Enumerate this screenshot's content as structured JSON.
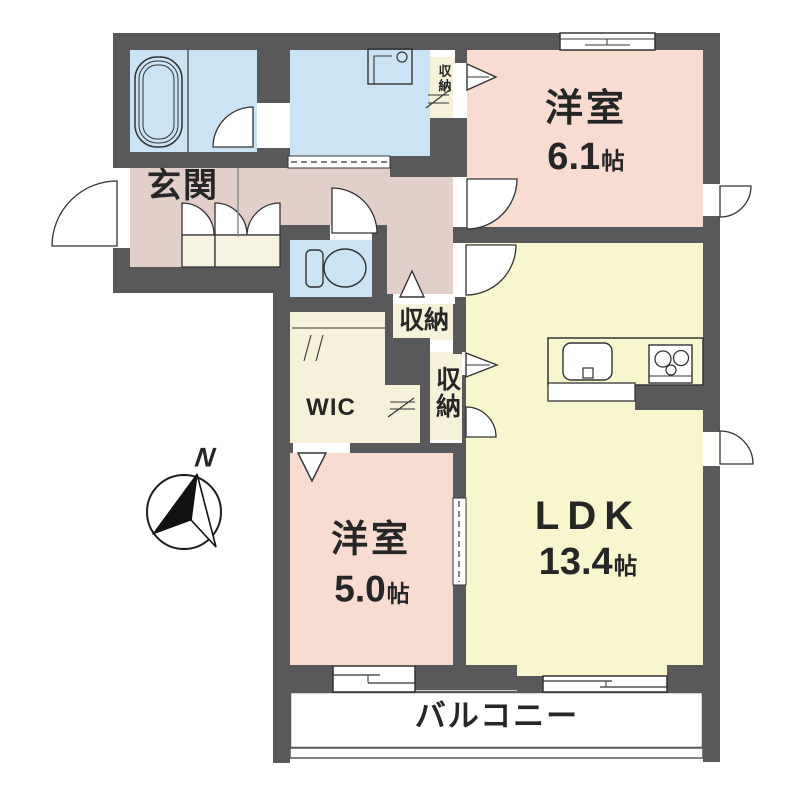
{
  "rooms": {
    "entrance": {
      "label": "玄関"
    },
    "bedroom1": {
      "label": "洋室",
      "size_value": "6.1",
      "size_unit": "帖"
    },
    "bedroom2": {
      "label": "洋室",
      "size_value": "5.0",
      "size_unit": "帖"
    },
    "ldk": {
      "label": "LDK",
      "size_value": "13.4",
      "size_unit": "帖"
    },
    "wic": {
      "label": "WIC"
    },
    "storage_upper": {
      "label": "収納"
    },
    "storage_hall": {
      "label": "収納"
    },
    "storage_ldk": {
      "label": "収納"
    },
    "balcony": {
      "label": "バルコニー"
    }
  },
  "compass": {
    "label": "N"
  },
  "icons": {
    "fixtures": [
      "bathtub-icon",
      "washing-machine-pan-icon",
      "toilet-icon",
      "kitchen-sink-icon",
      "gas-stove-icon",
      "shoe-cabinet-icon",
      "compass-north-icon"
    ]
  },
  "colors": {
    "wall": "#59595b",
    "western_room": "#f8dcd2",
    "hallway": "#e2cfc9",
    "ldk": "#f8f6cd",
    "storage": "#f6f2da",
    "wet_area": "#cae4f6",
    "closet_cabinet": "#f7f3e2",
    "balcony": "#ffffff",
    "fixture_line": "#333333",
    "text": "#262626"
  }
}
